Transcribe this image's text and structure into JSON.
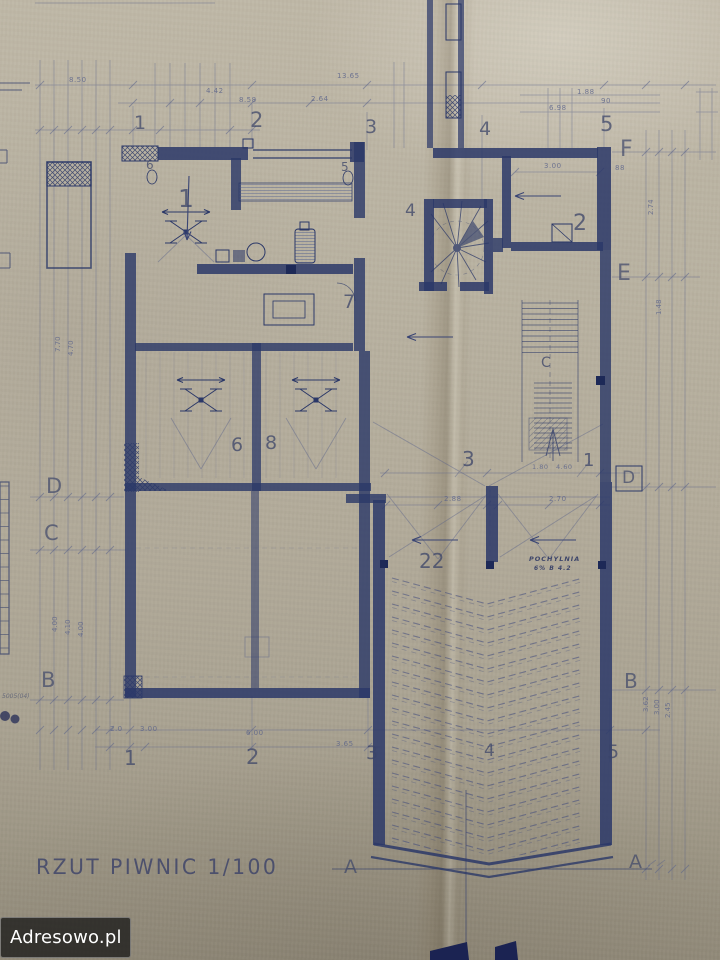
{
  "document": {
    "title": "RZUT PIWNIC 1/100",
    "drawing_type": "basement floor plan blueprint",
    "scale": "1/100"
  },
  "watermark": {
    "text": "Adresowo.pl"
  },
  "colors": {
    "paper": "#b2ab9a",
    "ink": "#2b3868",
    "pencil": "#59628a",
    "watermark_bg": "rgba(22,22,22,0.75)",
    "watermark_text": "#ffffff"
  },
  "plan": {
    "grid_columns": [
      "1",
      "2",
      "3",
      "4",
      "5"
    ],
    "grid_rows": [
      "A",
      "B",
      "C",
      "D",
      "E",
      "F"
    ],
    "room_numbers": [
      "1",
      "2",
      "3",
      "4",
      "5",
      "6",
      "7",
      "8",
      "22"
    ],
    "ramp_label": "POCHYLNIA",
    "section_line": "A—A"
  },
  "labels": [
    {
      "n": "grid-col-1-top",
      "t": "1",
      "x": 134,
      "y": 114,
      "s": 19,
      "c": "grid"
    },
    {
      "n": "grid-col-2-top",
      "t": "2",
      "x": 250,
      "y": 110,
      "s": 21,
      "c": "grid"
    },
    {
      "n": "grid-col-3-top",
      "t": "3",
      "x": 365,
      "y": 118,
      "s": 19,
      "c": "grid"
    },
    {
      "n": "grid-col-4-top",
      "t": "4",
      "x": 479,
      "y": 120,
      "s": 19,
      "c": "grid"
    },
    {
      "n": "grid-col-5-top",
      "t": "5",
      "x": 600,
      "y": 114,
      "s": 21,
      "c": "grid"
    },
    {
      "n": "grid-col-1-bottom",
      "t": "1",
      "x": 124,
      "y": 748,
      "s": 20,
      "c": "grid"
    },
    {
      "n": "grid-col-2-bottom",
      "t": "2",
      "x": 246,
      "y": 747,
      "s": 21,
      "c": "grid"
    },
    {
      "n": "grid-col-3-bottom",
      "t": "3",
      "x": 366,
      "y": 744,
      "s": 19,
      "c": "grid"
    },
    {
      "n": "grid-col-4-bottom",
      "t": "4",
      "x": 484,
      "y": 743,
      "s": 17,
      "c": "grid"
    },
    {
      "n": "grid-col-5-bottom",
      "t": "5",
      "x": 607,
      "y": 743,
      "s": 19,
      "c": "grid"
    },
    {
      "n": "grid-row-d-left",
      "t": "D",
      "x": 46,
      "y": 476,
      "s": 21,
      "c": "letter"
    },
    {
      "n": "grid-row-c-left",
      "t": "C",
      "x": 44,
      "y": 523,
      "s": 21,
      "c": "letter"
    },
    {
      "n": "grid-row-b-left",
      "t": "B",
      "x": 41,
      "y": 670,
      "s": 21,
      "c": "letter"
    },
    {
      "n": "grid-row-f-right",
      "t": "F",
      "x": 620,
      "y": 139,
      "s": 22,
      "c": "letter"
    },
    {
      "n": "grid-row-e-right",
      "t": "E",
      "x": 617,
      "y": 263,
      "s": 22,
      "c": "letter"
    },
    {
      "n": "grid-row-d-right",
      "t": "D",
      "x": 622,
      "y": 470,
      "s": 17,
      "c": "letter"
    },
    {
      "n": "grid-row-b-right",
      "t": "B",
      "x": 624,
      "y": 671,
      "s": 20,
      "c": "letter"
    },
    {
      "n": "section-a-left",
      "t": "A",
      "x": 344,
      "y": 858,
      "s": 19,
      "c": "letter"
    },
    {
      "n": "section-a-right",
      "t": "A",
      "x": 629,
      "y": 853,
      "s": 19,
      "c": "letter"
    },
    {
      "n": "room-1",
      "t": "1",
      "x": 178,
      "y": 186,
      "s": 25,
      "c": "room"
    },
    {
      "n": "room-2",
      "t": "2",
      "x": 573,
      "y": 213,
      "s": 22,
      "c": "room"
    },
    {
      "n": "room-4",
      "t": "4",
      "x": 405,
      "y": 203,
      "s": 17,
      "c": "room"
    },
    {
      "n": "room-7",
      "t": "7",
      "x": 343,
      "y": 293,
      "s": 19,
      "c": "room"
    },
    {
      "n": "room-6",
      "t": "6",
      "x": 231,
      "y": 436,
      "s": 19,
      "c": "room"
    },
    {
      "n": "room-8",
      "t": "8",
      "x": 265,
      "y": 434,
      "s": 19,
      "c": "room"
    },
    {
      "n": "room-3-ramp",
      "t": "3",
      "x": 462,
      "y": 449,
      "s": 20,
      "c": "room"
    },
    {
      "n": "room-1-ramp",
      "t": "1",
      "x": 583,
      "y": 452,
      "s": 18,
      "c": "room"
    },
    {
      "n": "room-22-ramp",
      "t": "22",
      "x": 419,
      "y": 551,
      "s": 20,
      "c": "room"
    },
    {
      "n": "stair-label-c",
      "t": "C",
      "x": 541,
      "y": 356,
      "s": 14,
      "c": "room"
    },
    {
      "n": "door-number-6",
      "t": "6",
      "x": 146,
      "y": 159,
      "s": 12,
      "c": "room"
    },
    {
      "n": "door-number-5",
      "t": "5",
      "x": 341,
      "y": 161,
      "s": 12,
      "c": "room"
    },
    {
      "n": "ramp-name",
      "t": "POCHYLNIA",
      "x": 529,
      "y": 556,
      "s": 6.5,
      "c": "note"
    },
    {
      "n": "ramp-slope-note",
      "t": "6% B 4.2",
      "x": 534,
      "y": 566,
      "s": 6,
      "c": "note"
    },
    {
      "n": "dim-850",
      "t": "8.50",
      "x": 69,
      "y": 77,
      "s": 7,
      "c": "dim"
    },
    {
      "n": "dim-1365",
      "t": "13.65",
      "x": 337,
      "y": 73,
      "s": 7,
      "c": "dim"
    },
    {
      "n": "dim-442",
      "t": "4.42",
      "x": 206,
      "y": 88,
      "s": 7,
      "c": "dim"
    },
    {
      "n": "dim-858",
      "t": "8.58",
      "x": 239,
      "y": 97,
      "s": 7,
      "c": "dim"
    },
    {
      "n": "dim-264",
      "t": "2.64",
      "x": 311,
      "y": 96,
      "s": 7,
      "c": "dim"
    },
    {
      "n": "dim-188",
      "t": "1.88",
      "x": 577,
      "y": 89,
      "s": 7,
      "c": "dim"
    },
    {
      "n": "dim-698",
      "t": "6.98",
      "x": 549,
      "y": 105,
      "s": 7,
      "c": "dim"
    },
    {
      "n": "dim-90",
      "t": "90",
      "x": 601,
      "y": 98,
      "s": 7,
      "c": "dim"
    },
    {
      "n": "dim-300-a",
      "t": "3.00",
      "x": 544,
      "y": 163,
      "s": 7,
      "c": "dim"
    },
    {
      "n": "dim-88",
      "t": "88",
      "x": 615,
      "y": 165,
      "s": 7,
      "c": "dim"
    },
    {
      "n": "dim-288",
      "t": "2.88",
      "x": 444,
      "y": 496,
      "s": 7,
      "c": "dim"
    },
    {
      "n": "dim-270",
      "t": "2.70",
      "x": 549,
      "y": 496,
      "s": 7,
      "c": "dim"
    },
    {
      "n": "dim-180",
      "t": "1.80",
      "x": 532,
      "y": 464,
      "s": 6.5,
      "c": "dim"
    },
    {
      "n": "dim-460",
      "t": "4.60",
      "x": 556,
      "y": 464,
      "s": 6.5,
      "c": "dim"
    },
    {
      "n": "dim-20",
      "t": "2.0",
      "x": 110,
      "y": 726,
      "s": 7,
      "c": "dim"
    },
    {
      "n": "dim-300-b",
      "t": "3.00",
      "x": 140,
      "y": 726,
      "s": 7,
      "c": "dim"
    },
    {
      "n": "dim-600",
      "t": "6.00",
      "x": 246,
      "y": 730,
      "s": 7,
      "c": "dim"
    },
    {
      "n": "dim-365",
      "t": "3.65",
      "x": 336,
      "y": 741,
      "s": 7,
      "c": "dim"
    },
    {
      "n": "dimv-400-a",
      "t": "4.00",
      "x": 52,
      "y": 632,
      "s": 7,
      "c": "dimv",
      "r": -90
    },
    {
      "n": "dimv-410",
      "t": "4.10",
      "x": 65,
      "y": 635,
      "s": 7,
      "c": "dimv",
      "r": -90
    },
    {
      "n": "dimv-400-b",
      "t": "4.00",
      "x": 78,
      "y": 637,
      "s": 7,
      "c": "dimv",
      "r": -90
    },
    {
      "n": "dimv-770",
      "t": "7.70",
      "x": 55,
      "y": 352,
      "s": 7,
      "c": "dimv",
      "r": -90
    },
    {
      "n": "dimv-470",
      "t": "4.70",
      "x": 68,
      "y": 356,
      "s": 7,
      "c": "dimv",
      "r": -90
    },
    {
      "n": "dimv-362",
      "t": "3.62",
      "x": 643,
      "y": 712,
      "s": 7,
      "c": "dimv",
      "r": -90
    },
    {
      "n": "dimv-300-c",
      "t": "3.00",
      "x": 654,
      "y": 715,
      "s": 7,
      "c": "dimv",
      "r": -90
    },
    {
      "n": "dimv-245",
      "t": "2.45",
      "x": 665,
      "y": 718,
      "s": 7,
      "c": "dimv",
      "r": -90
    },
    {
      "n": "dimv-274",
      "t": "2.74",
      "x": 648,
      "y": 215,
      "s": 7,
      "c": "dimv",
      "r": -90
    },
    {
      "n": "dimv-148",
      "t": "1.48",
      "x": 656,
      "y": 315,
      "s": 7,
      "c": "dimv",
      "r": -90
    },
    {
      "n": "margin-annotation",
      "t": "5005(04)",
      "x": 2,
      "y": 694,
      "s": 6,
      "c": "hand"
    }
  ]
}
